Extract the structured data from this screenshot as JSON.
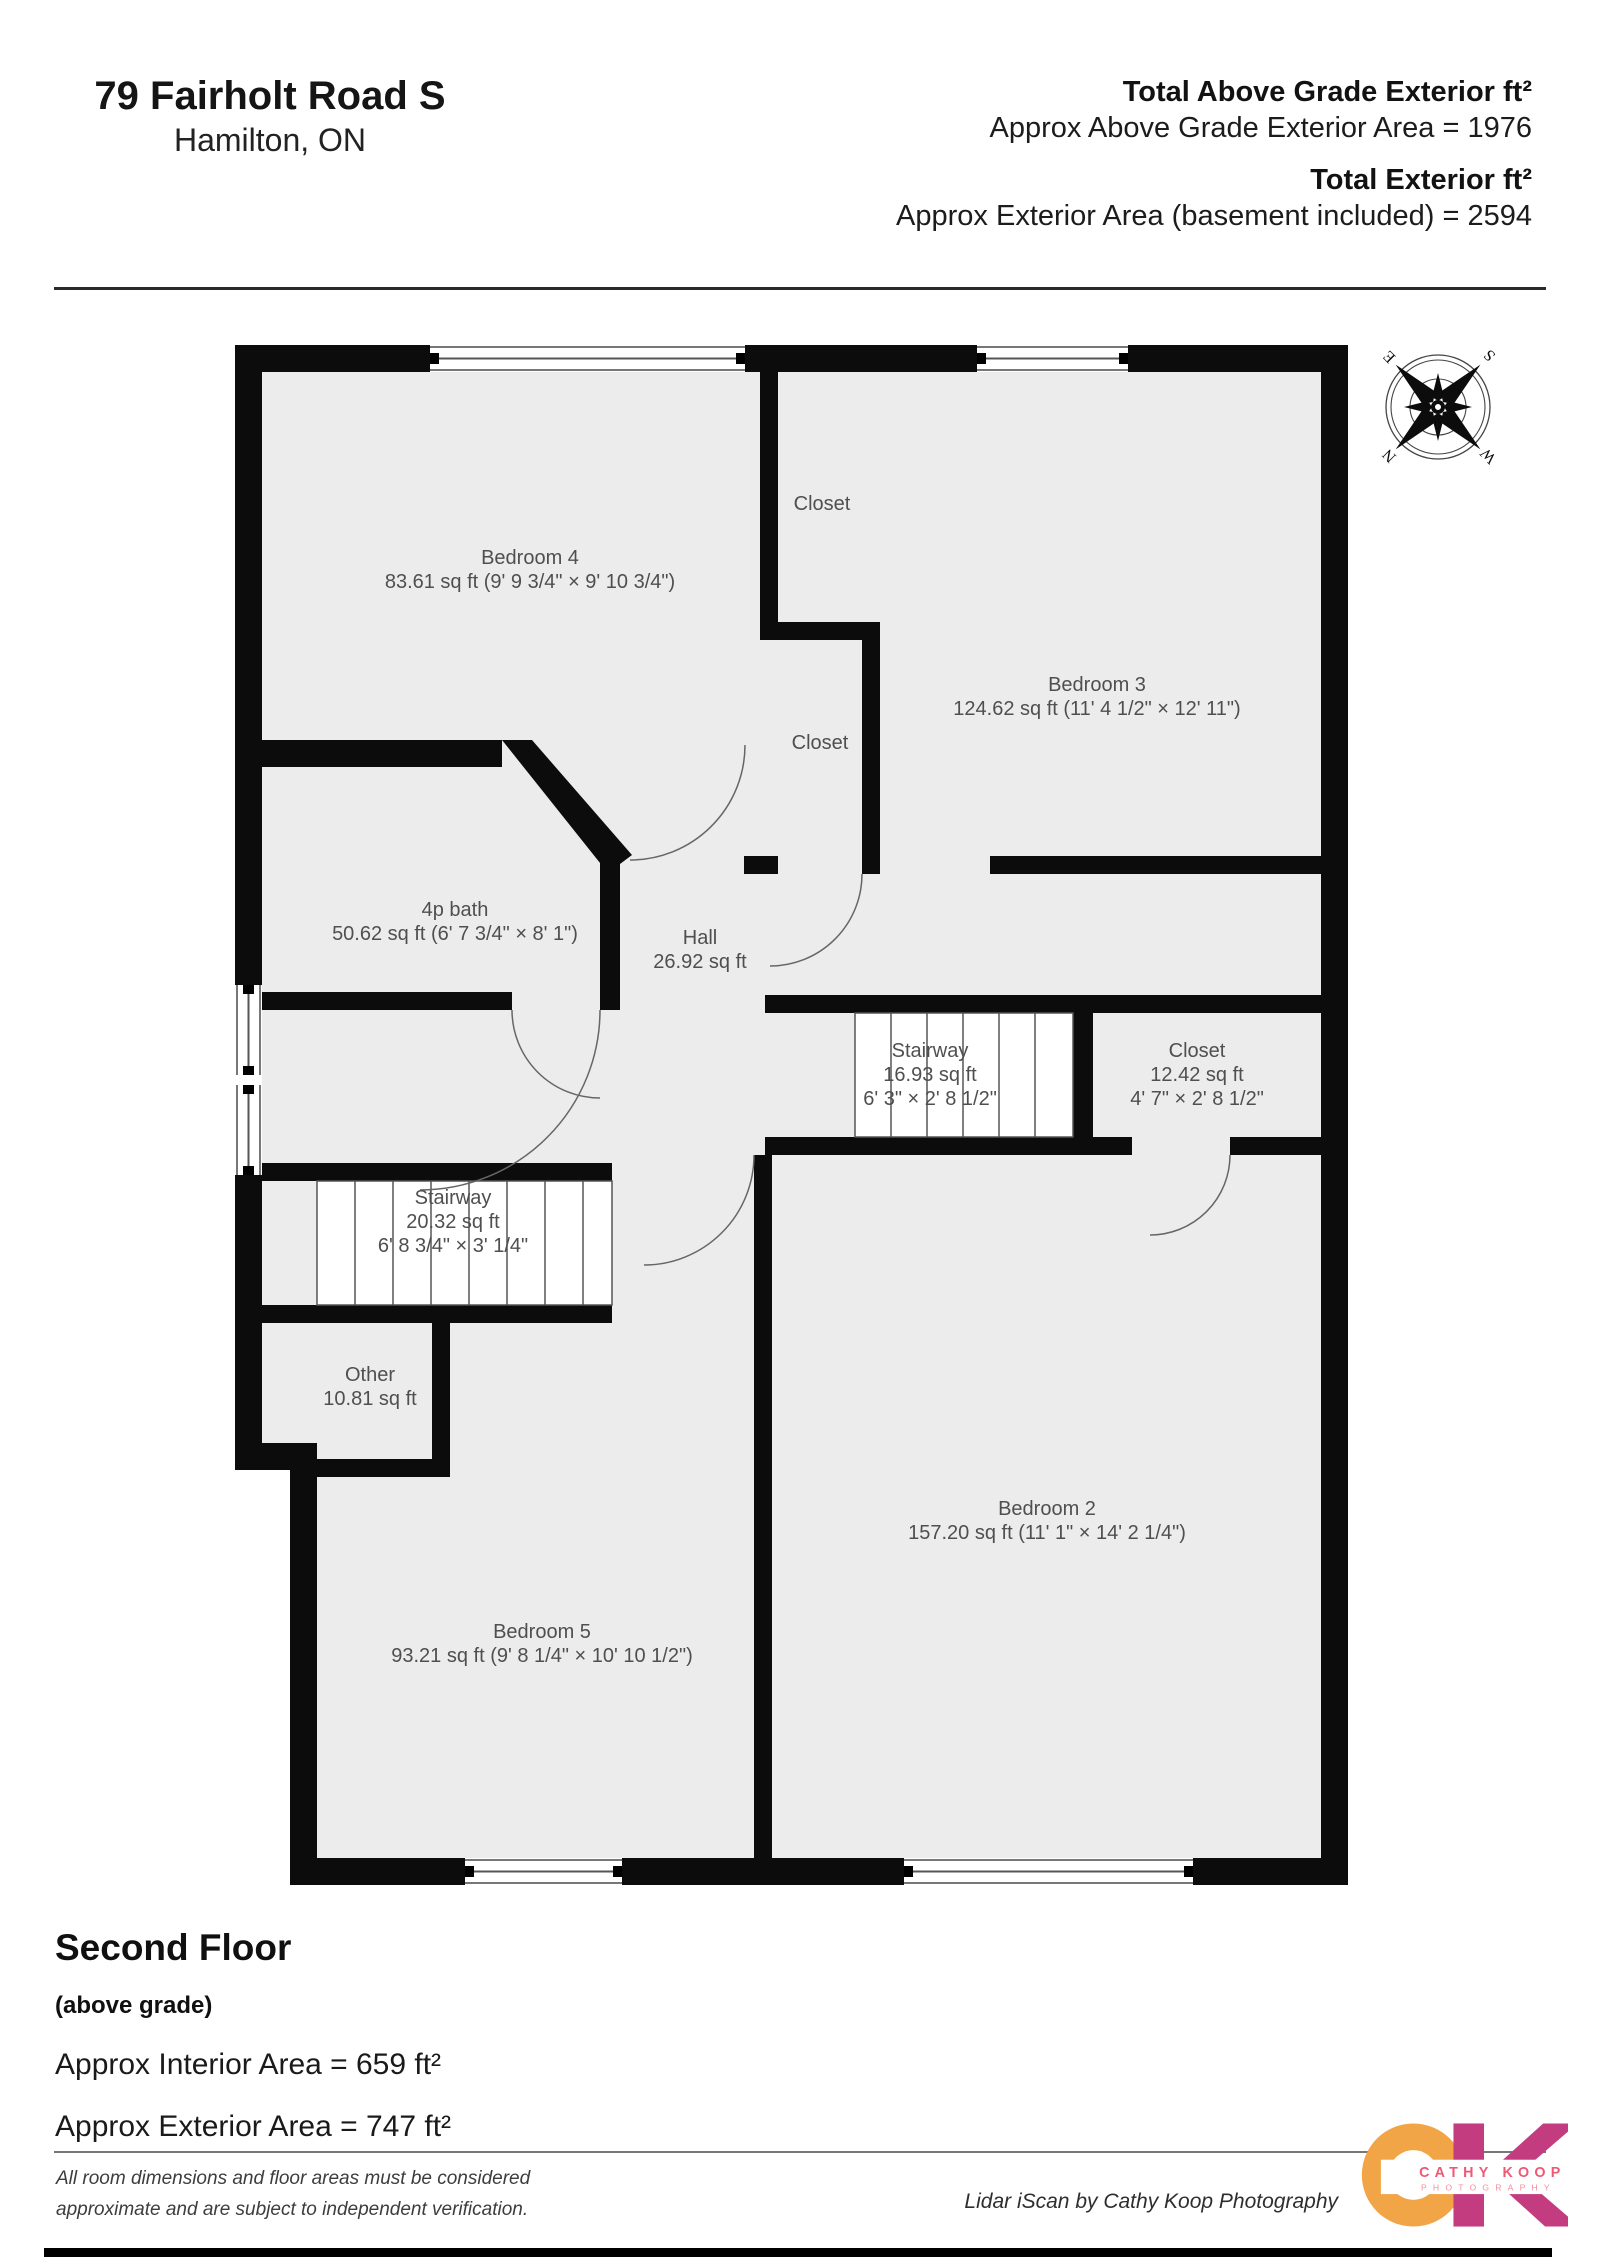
{
  "header": {
    "address_line1": "79 Fairholt Road S",
    "address_line2": "Hamilton, ON",
    "total1_label": "Total Above Grade Exterior ft²",
    "total1_value": "Approx Above Grade Exterior Area = 1976",
    "total2_label": "Total Exterior ft²",
    "total2_value": "Approx Exterior Area (basement included) = 2594"
  },
  "floorplan": {
    "compass": {
      "n": "N",
      "e": "E",
      "s": "S",
      "w": "W"
    },
    "rooms": [
      {
        "name": "Bedroom 4",
        "detail": "83.61 sq ft (9' 9 3/4\" × 9' 10 3/4\")"
      },
      {
        "name": "Closet"
      },
      {
        "name": "Bedroom 3",
        "detail": "124.62 sq ft (11' 4 1/2\" × 12' 11\")"
      },
      {
        "name": "Closet"
      },
      {
        "name": "4p bath",
        "detail": "50.62 sq ft (6' 7 3/4\" × 8' 1\")"
      },
      {
        "name": "Hall",
        "detail": "26.92 sq ft"
      },
      {
        "name": "Stairway",
        "detail": "16.93 sq ft",
        "detail2": "6' 3\" × 2' 8 1/2\""
      },
      {
        "name": "Closet",
        "detail": "12.42 sq ft",
        "detail2": "4' 7\" × 2' 8 1/2\""
      },
      {
        "name": "Stairway",
        "detail": "20.32 sq ft",
        "detail2": "6' 8 3/4\" × 3' 1/4\""
      },
      {
        "name": "Other",
        "detail": "10.81 sq ft"
      },
      {
        "name": "Bedroom 2",
        "detail": "157.20 sq ft (11' 1\" × 14' 2 1/4\")"
      },
      {
        "name": "Bedroom 5",
        "detail": "93.21 sq ft (9' 8 1/4\" × 10' 10 1/2\")"
      }
    ]
  },
  "summary": {
    "title": "Second Floor",
    "subtitle": "(above grade)",
    "interior_area": "Approx Interior Area = 659 ft²",
    "exterior_area": "Approx Exterior Area = 747 ft²"
  },
  "footer": {
    "disclaimer_line1": "All room dimensions and floor areas must be considered",
    "disclaimer_line2": "approximate and are subject to independent verification.",
    "credit": "Lidar iScan by Cathy Koop Photography"
  },
  "logo": {
    "brand_line1": "CATHY KOOP",
    "brand_line2": "PHOTOGRAPHY",
    "orange": "#F2A546",
    "magenta": "#C43C80",
    "text_color": "#EE5A74"
  }
}
